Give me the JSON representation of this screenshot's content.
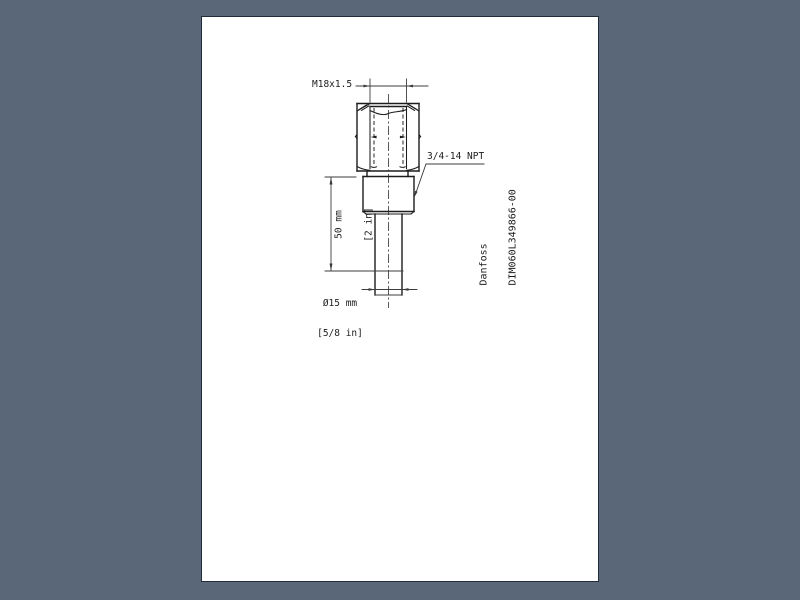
{
  "colors": {
    "background": "#5a6779",
    "page": "#ffffff",
    "page_border": "#232c3c",
    "ink": "#1d1d1d",
    "ink_thin": "#3d3d3d"
  },
  "drawing": {
    "dimensions": {
      "top_thread": "M18x1.5",
      "bottom_thread": "3/4-14 NPT",
      "length_mm": "50 mm",
      "length_in": "[2 in]",
      "diameter_mm": "Ø15 mm",
      "diameter_in": "[5/8 in]"
    },
    "title_block": {
      "manufacturer": "Danfoss",
      "document_id": "DIM060L349866-00"
    }
  }
}
